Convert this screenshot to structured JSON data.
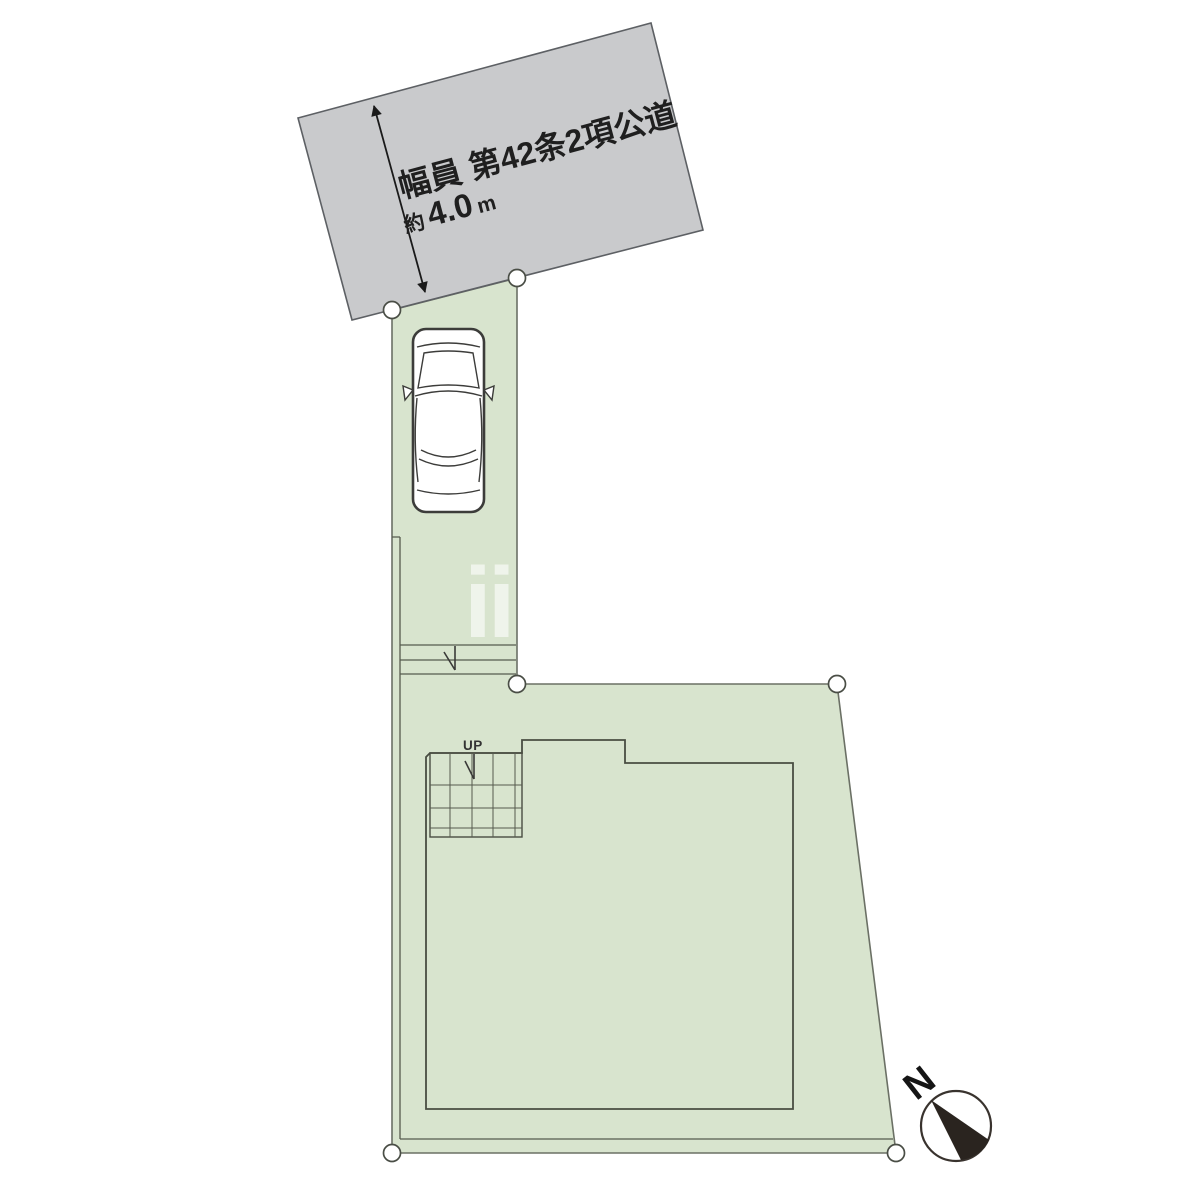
{
  "road": {
    "label": "幅員 第42条2項公道",
    "width_prefix": "約",
    "width_value": "4.0",
    "width_unit": "m"
  },
  "site": {
    "up_label": "UP"
  },
  "compass": {
    "north_label": "N"
  },
  "watermark": {
    "text": "ii"
  },
  "colors": {
    "parcel_fill": "#d8e4ce",
    "road_fill": "#c9cacc",
    "needle_fill": "#2a241f",
    "line_dark": "#1a1a1a"
  }
}
